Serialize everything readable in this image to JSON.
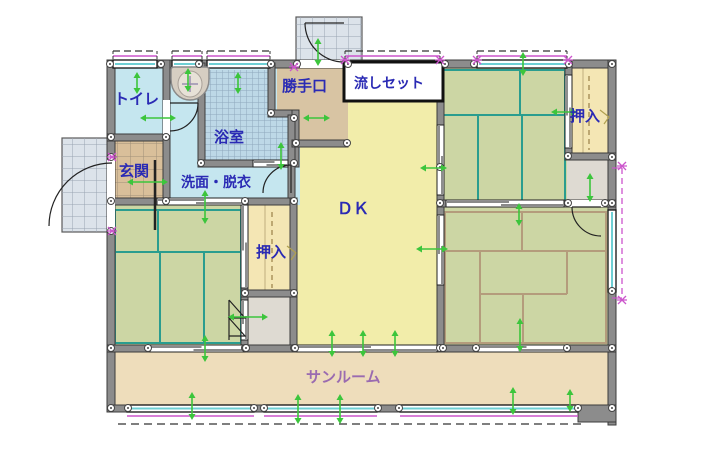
{
  "plan": {
    "type": "floor-plan",
    "rooms": {
      "toilet": {
        "label": "トイレ"
      },
      "genkan": {
        "label": "玄関"
      },
      "bathroom": {
        "label": "浴室"
      },
      "washroom": {
        "label": "洗面・脱衣"
      },
      "katteguchi": {
        "label": "勝手口"
      },
      "sink_unit": {
        "label": "流しセット"
      },
      "dk": {
        "label": "ＤＫ"
      },
      "oshiire_middle": {
        "label": "押入"
      },
      "oshiire_right": {
        "label": "押入"
      },
      "sunroom": {
        "label": "サンルーム"
      }
    },
    "colors": {
      "label_blue": "#2a2ab4",
      "label_purple": "#9a6bb0",
      "tatami_green": "#ccd6a4",
      "tatami_teal": "#2a9d8f",
      "tatami_tan": "#b49c7c",
      "dk_yellow": "#f2edaa",
      "oshiire_yellow": "#f4e6b4",
      "oshiire_dash": "#a08850",
      "sunroom_tan": "#eeddbb",
      "genkan_tan": "#d9bf9a",
      "katte_tan": "#d8c4a3",
      "washroom_cyan": "#c5e6ef",
      "bath_blue": "#bdd8e7",
      "storage_gray": "#dedad2",
      "porch_gray": "#dce3ea",
      "wall_gray": "#8c8c8c",
      "handle_green": "#3cc53c",
      "eave_magenta": "#cc55cc",
      "window_cyan": "#6ecfd4"
    }
  }
}
